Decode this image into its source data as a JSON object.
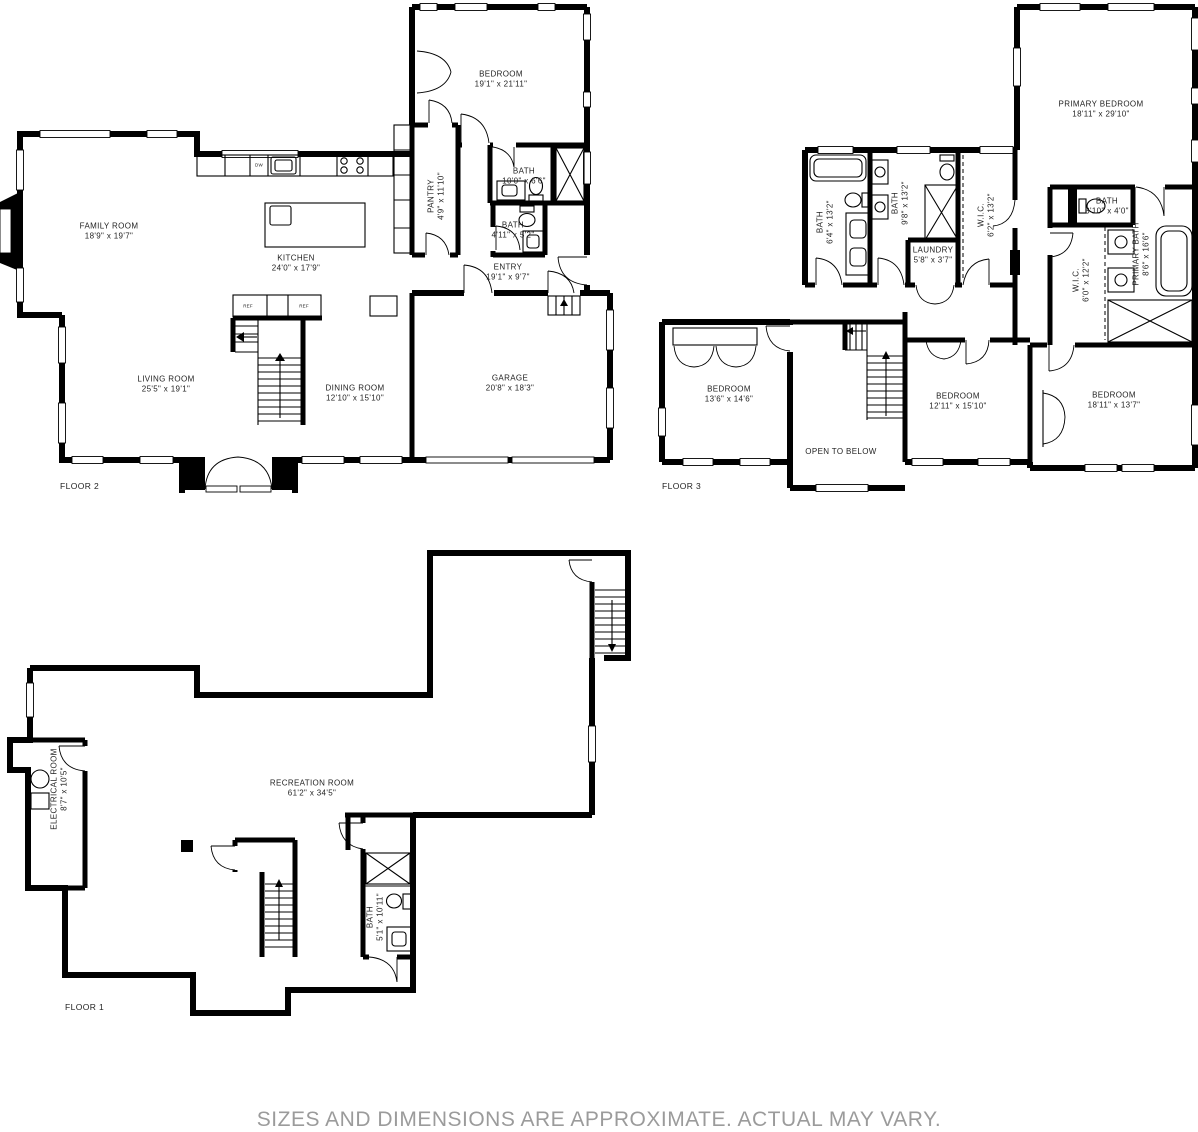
{
  "page": {
    "disclaimer": "SIZES AND DIMENSIONS ARE APPROXIMATE. ACTUAL MAY VARY.",
    "background": "#ffffff",
    "wall_color": "#000000",
    "label_color": "#1f1f1f",
    "disclaimer_color": "#9b9b9b"
  },
  "floors": [
    {
      "name": "FLOOR 2",
      "appliances": [
        "DW",
        "REF",
        "REF"
      ],
      "rooms": [
        {
          "label": "FAMILY ROOM",
          "dims": "18'9\" x 19'7\""
        },
        {
          "label": "KITCHEN",
          "dims": "24'0\" x 17'9\""
        },
        {
          "label": "BEDROOM",
          "dims": "19'1\" x 21'11\""
        },
        {
          "label": "PANTRY",
          "dims": "4'9\" x 11'10\""
        },
        {
          "label": "BATH",
          "dims": "10'0\" x 6'6\""
        },
        {
          "label": "BATH",
          "dims": "4'11\" x 5'2\""
        },
        {
          "label": "ENTRY",
          "dims": "19'1\" x 9'7\""
        },
        {
          "label": "LIVING ROOM",
          "dims": "25'5\" x 19'1\""
        },
        {
          "label": "DINING ROOM",
          "dims": "12'10\" x 15'10\""
        },
        {
          "label": "GARAGE",
          "dims": "20'8\" x 18'3\""
        }
      ]
    },
    {
      "name": "FLOOR 3",
      "rooms": [
        {
          "label": "PRIMARY BEDROOM",
          "dims": "18'11\" x 29'10\""
        },
        {
          "label": "BATH",
          "dims": "6'4\" x 13'2\""
        },
        {
          "label": "BATH",
          "dims": "9'8\" x 13'2\""
        },
        {
          "label": "W.I.C.",
          "dims": "6'2\" x 13'2\""
        },
        {
          "label": "LAUNDRY",
          "dims": "5'8\" x 3'7\""
        },
        {
          "label": "BATH",
          "dims": "3'10\" x 4'0\""
        },
        {
          "label": "W.I.C.",
          "dims": "6'0\" x 12'2\""
        },
        {
          "label": "PRIMARY BATH",
          "dims": "8'6\" x 16'6\""
        },
        {
          "label": "BEDROOM",
          "dims": "13'6\" x 14'6\""
        },
        {
          "label": "OPEN TO BELOW",
          "dims": ""
        },
        {
          "label": "BEDROOM",
          "dims": "12'11\" x 15'10\""
        },
        {
          "label": "BEDROOM",
          "dims": "18'11\" x 13'7\""
        }
      ]
    },
    {
      "name": "FLOOR 1",
      "rooms": [
        {
          "label": "RECREATION ROOM",
          "dims": "61'2\" x 34'5\""
        },
        {
          "label": "ELECTRICAL ROOM",
          "dims": "8'7\" x 10'5\""
        },
        {
          "label": "BATH",
          "dims": "5'1\" x 10'11\""
        }
      ]
    }
  ]
}
